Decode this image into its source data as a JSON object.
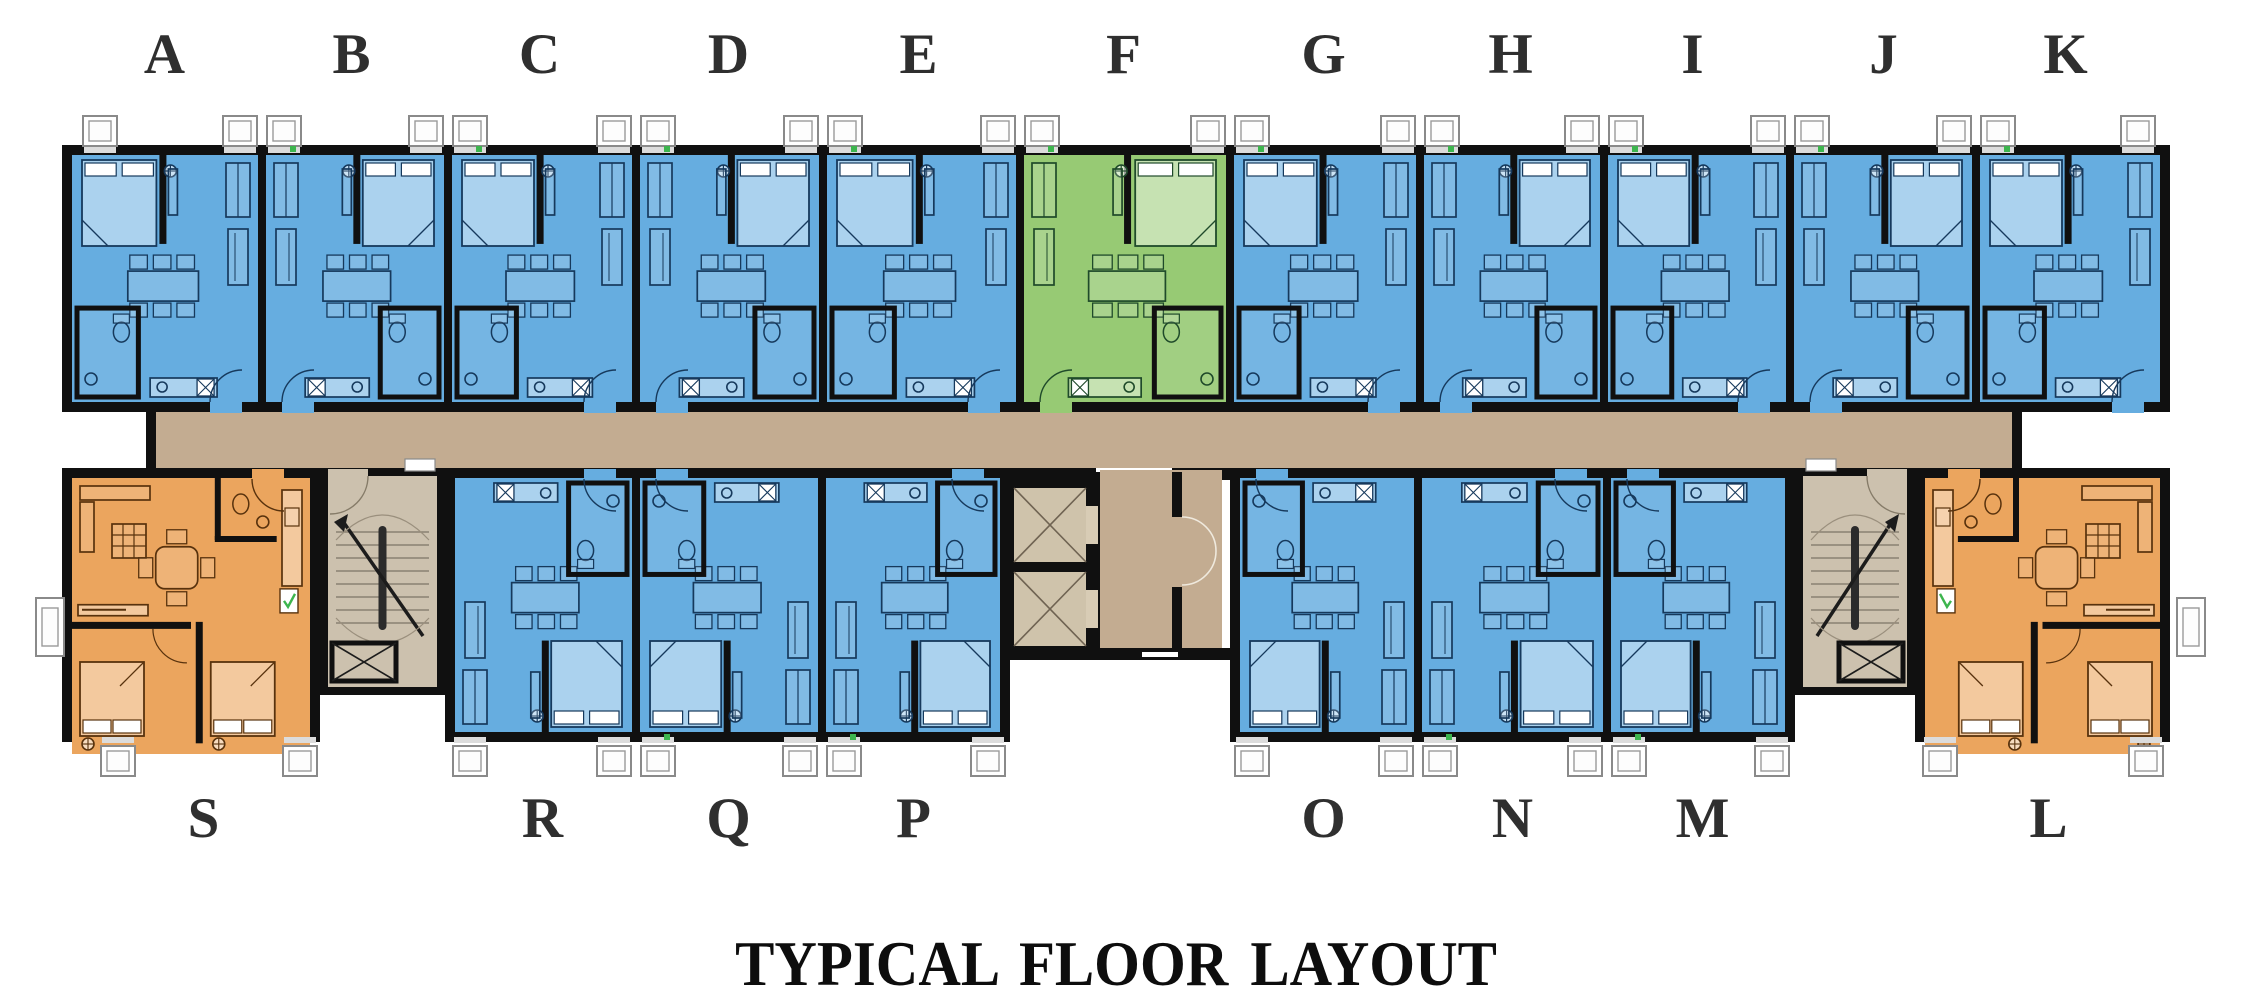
{
  "title": "TYPICAL FLOOR LAYOUT",
  "plan": {
    "top_row": {
      "labels": [
        "A",
        "B",
        "C",
        "D",
        "E",
        "F",
        "G",
        "H",
        "I",
        "J",
        "K"
      ]
    },
    "bottom_row": {
      "labels": [
        "S",
        "R",
        "Q",
        "P",
        "O",
        "N",
        "M",
        "L"
      ]
    },
    "unit_types": {
      "standard_unit_color": "blue",
      "highlighted_unit": "F",
      "highlighted_unit_color": "green",
      "corner_units": [
        "S",
        "L"
      ],
      "corner_unit_color": "orange"
    }
  },
  "colors": {
    "unit_blue": "#66ade0",
    "unit_green": "#97ca74",
    "unit_orange": "#eba55e",
    "corridor_tan": "#c3ac91",
    "stair_floor_tan": "#ccc1ae",
    "elevator_floor_tan": "#cfc3ab",
    "wall_black": "#101010",
    "furniture_blue_line": "#16395c",
    "furniture_green_line": "#1f4a2a",
    "furniture_orange_line": "#58320d",
    "label_gray": "#2f2f2f",
    "door_sensor_green": "#3db54e",
    "ac_box_white": "#ffffff"
  }
}
